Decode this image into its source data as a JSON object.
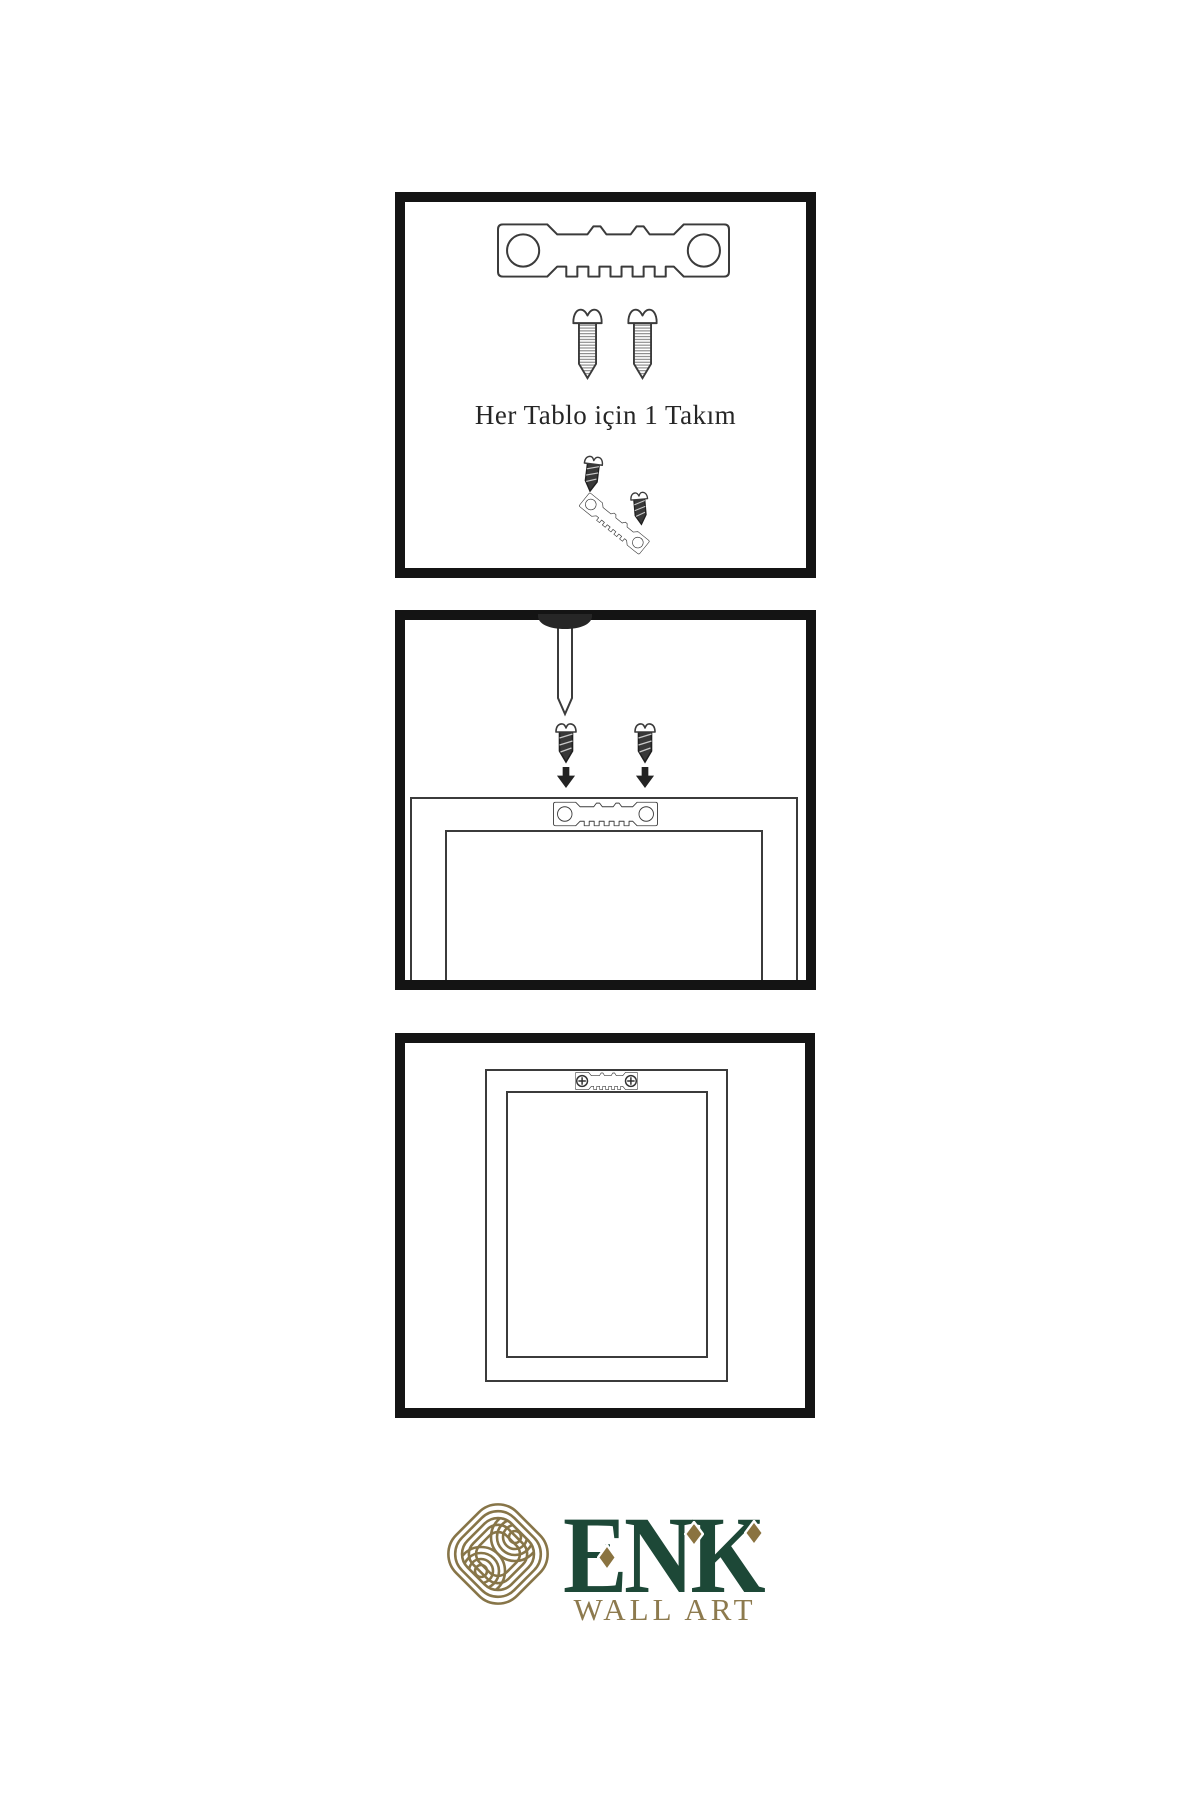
{
  "instructions": {
    "step1": {
      "caption": "Her Tablo için 1 Takım",
      "parts": [
        "sawtooth-hanger",
        "screw",
        "screw"
      ]
    },
    "step2": {
      "parts": [
        "wall-nail",
        "screw",
        "screw",
        "sawtooth-hanger",
        "frame-back"
      ]
    },
    "step3": {
      "parts": [
        "mounted-sawtooth-hanger",
        "hung-frame"
      ]
    }
  },
  "logo": {
    "brand": "ENK",
    "tagline": "WALL ART"
  },
  "icons": [
    "sawtooth-hanger-icon",
    "threaded-screw-icon",
    "dark-screw-icon",
    "wall-nail-icon",
    "down-arrow-icon",
    "phillips-screw-head-icon",
    "knot-logo-icon",
    "diamond-icon"
  ],
  "colors": {
    "panel_border": "#141414",
    "line_art": "#3b3b3b",
    "dark_fill": "#2e2e2e",
    "caption_color": "#262626",
    "logo_green": "#1d4837",
    "logo_gold": "#877548",
    "logo_gold_text": "#8d7a4e",
    "diamond_gold": "#8a7340",
    "background": "#ffffff"
  }
}
